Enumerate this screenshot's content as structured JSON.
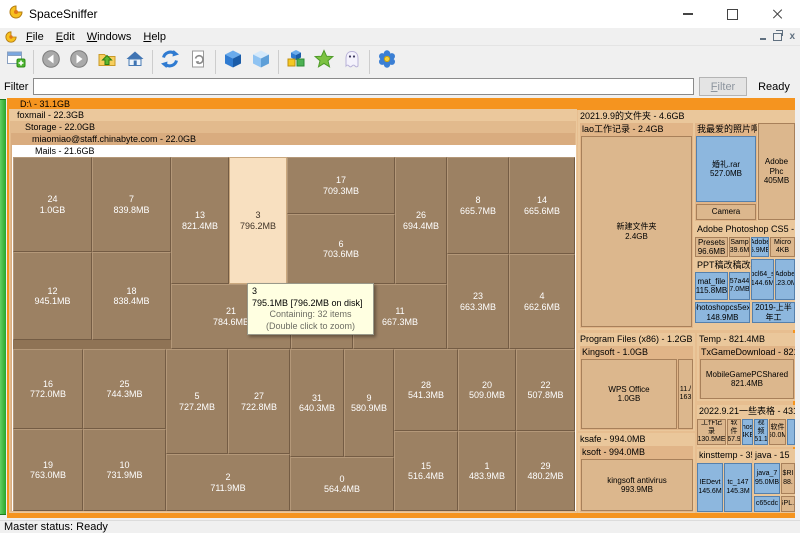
{
  "window": {
    "title": "SpaceSniffer"
  },
  "menu": {
    "items": [
      {
        "label": "File"
      },
      {
        "label": "Edit"
      },
      {
        "label": "Windows"
      },
      {
        "label": "Help"
      }
    ]
  },
  "toolbar": {
    "groups": [
      [
        "new-view"
      ],
      [
        "back",
        "forward",
        "parent-folder",
        "home"
      ],
      [
        "refresh",
        "refresh-selection"
      ],
      [
        "cube-solid",
        "cube-free-space"
      ],
      [
        "cubes-detail",
        "star-filter",
        "ghost-hidden"
      ],
      [
        "options-flower"
      ]
    ]
  },
  "filter": {
    "label": "Filter",
    "input_value": "",
    "button_label": "Filter",
    "status": "Ready"
  },
  "status_bar": {
    "text": "Master status: Ready"
  },
  "treemap": {
    "root_header": "D:\\ - 31.1GB",
    "nested_headers": [
      {
        "text": "foxmail - 22.3GB",
        "x": 9,
        "y": 12,
        "w": 568,
        "h": 404,
        "indent": 8
      },
      {
        "text": "Storage - 22.0GB",
        "x": 10,
        "y": 24,
        "w": 566,
        "h": 391,
        "indent": 15
      },
      {
        "text": "miaomiao@staff.chinabyte.com - 22.0GB",
        "x": 11,
        "y": 36,
        "w": 564,
        "h": 378,
        "indent": 21
      },
      {
        "text": "Mails - 21.6GB",
        "x": 12,
        "y": 48,
        "w": 564,
        "h": 366,
        "indent": 23
      }
    ],
    "mails_blocks": [
      {
        "n": "24",
        "s": "1.0GB",
        "x": 0,
        "y": 0,
        "w": 79,
        "h": 95
      },
      {
        "n": "7",
        "s": "839.8MB",
        "x": 79,
        "y": 0,
        "w": 79,
        "h": 95
      },
      {
        "n": "13",
        "s": "821.4MB",
        "x": 158,
        "y": 0,
        "w": 58,
        "h": 127
      },
      {
        "n": "3",
        "s": "796.2MB",
        "x": 216,
        "y": 0,
        "w": 58,
        "h": 127,
        "hl": true
      },
      {
        "n": "17",
        "s": "709.3MB",
        "x": 274,
        "y": 0,
        "w": 108,
        "h": 57
      },
      {
        "n": "26",
        "s": "694.4MB",
        "x": 382,
        "y": 0,
        "w": 52,
        "h": 127
      },
      {
        "n": "8",
        "s": "665.7MB",
        "x": 434,
        "y": 0,
        "w": 62,
        "h": 97
      },
      {
        "n": "14",
        "s": "665.6MB",
        "x": 496,
        "y": 0,
        "w": 66,
        "h": 97
      },
      {
        "n": "6",
        "s": "703.6MB",
        "x": 274,
        "y": 57,
        "w": 108,
        "h": 70
      },
      {
        "n": "12",
        "s": "945.1MB",
        "x": 0,
        "y": 95,
        "w": 79,
        "h": 88
      },
      {
        "n": "18",
        "s": "838.4MB",
        "x": 79,
        "y": 95,
        "w": 79,
        "h": 88
      },
      {
        "n": "23",
        "s": "663.3MB",
        "x": 434,
        "y": 97,
        "w": 62,
        "h": 95
      },
      {
        "n": "4",
        "s": "662.6MB",
        "x": 496,
        "y": 97,
        "w": 66,
        "h": 95
      },
      {
        "n": "21",
        "s": "784.6MB",
        "x": 158,
        "y": 127,
        "w": 120,
        "h": 65
      },
      {
        "n": "",
        "s": "",
        "x": 278,
        "y": 127,
        "w": 62,
        "h": 65
      },
      {
        "n": "11",
        "s": "667.3MB",
        "x": 340,
        "y": 127,
        "w": 94,
        "h": 65
      },
      {
        "n": "16",
        "s": "772.0MB",
        "x": 0,
        "y": 192,
        "w": 70,
        "h": 80
      },
      {
        "n": "25",
        "s": "744.3MB",
        "x": 70,
        "y": 192,
        "w": 83,
        "h": 80
      },
      {
        "n": "5",
        "s": "727.2MB",
        "x": 153,
        "y": 192,
        "w": 62,
        "h": 105
      },
      {
        "n": "27",
        "s": "722.8MB",
        "x": 215,
        "y": 192,
        "w": 62,
        "h": 105
      },
      {
        "n": "31",
        "s": "640.3MB",
        "x": 277,
        "y": 192,
        "w": 54,
        "h": 108
      },
      {
        "n": "9",
        "s": "580.9MB",
        "x": 331,
        "y": 192,
        "w": 50,
        "h": 108
      },
      {
        "n": "28",
        "s": "541.3MB",
        "x": 381,
        "y": 192,
        "w": 64,
        "h": 82
      },
      {
        "n": "20",
        "s": "509.0MB",
        "x": 445,
        "y": 192,
        "w": 58,
        "h": 82
      },
      {
        "n": "22",
        "s": "507.8MB",
        "x": 503,
        "y": 192,
        "w": 59,
        "h": 82
      },
      {
        "n": "19",
        "s": "763.0MB",
        "x": 0,
        "y": 272,
        "w": 70,
        "h": 82
      },
      {
        "n": "10",
        "s": "731.9MB",
        "x": 70,
        "y": 272,
        "w": 83,
        "h": 82
      },
      {
        "n": "2",
        "s": "711.9MB",
        "x": 153,
        "y": 297,
        "w": 124,
        "h": 57
      },
      {
        "n": "0",
        "s": "564.4MB",
        "x": 277,
        "y": 300,
        "w": 104,
        "h": 54
      },
      {
        "n": "15",
        "s": "516.4MB",
        "x": 381,
        "y": 274,
        "w": 64,
        "h": 80
      },
      {
        "n": "1",
        "s": "483.9MB",
        "x": 445,
        "y": 274,
        "w": 58,
        "h": 80
      },
      {
        "n": "29",
        "s": "480.2MB",
        "x": 503,
        "y": 274,
        "w": 59,
        "h": 80
      }
    ],
    "tooltip": {
      "title": "3",
      "size_line": "795.1MB [796.2MB on disk]",
      "containing": "Containing: 32 items",
      "hint": "(Double click to zoom)"
    },
    "right_panel": [
      {
        "k": "w",
        "x": 578,
        "y": 13,
        "w": 217,
        "h": 220,
        "c": "w1"
      },
      {
        "k": "h",
        "text": "2021.9.9的文件夹 - 4.6GB",
        "x": 578,
        "y": 13,
        "w": 217,
        "h": 12
      },
      {
        "k": "w",
        "x": 580,
        "y": 26,
        "w": 113,
        "h": 205,
        "c": "w2"
      },
      {
        "k": "h",
        "text": "lao工作记录 - 2.4GB",
        "x": 580,
        "y": 26,
        "w": 113,
        "h": 12
      },
      {
        "k": "b",
        "l1": "新建文件夹",
        "l2": "2.4GB",
        "x": 581,
        "y": 39,
        "w": 111,
        "h": 191,
        "c": "tan"
      },
      {
        "k": "w",
        "x": 695,
        "y": 26,
        "w": 62,
        "h": 98,
        "c": "w2"
      },
      {
        "k": "h",
        "text": "我最爱的照片啊 - 65",
        "x": 695,
        "y": 26,
        "w": 62,
        "h": 12
      },
      {
        "k": "b",
        "l1": "婚礼.rar",
        "l2": "527.0MB",
        "x": 696,
        "y": 39,
        "w": 60,
        "h": 66,
        "c": "blue"
      },
      {
        "k": "b",
        "l1": "Camera",
        "x": 696,
        "y": 107,
        "w": 60,
        "h": 16,
        "c": "tan"
      },
      {
        "k": "b",
        "l1": "Adobe Phc",
        "l2": "405MB",
        "x": 758,
        "y": 26,
        "w": 37,
        "h": 97,
        "c": "tan"
      },
      {
        "k": "h",
        "text": "Adobe Photoshop CS5 - 387.1M",
        "x": 695,
        "y": 126,
        "w": 100,
        "h": 12
      },
      {
        "k": "b",
        "l1": "Presets",
        "l2": "96.6MB",
        "x": 695,
        "y": 140,
        "w": 33,
        "h": 20,
        "c": "tan"
      },
      {
        "k": "b",
        "l1": "Samp",
        "l2": "39.6M",
        "x": 729,
        "y": 140,
        "w": 21,
        "h": 20,
        "c": "tan"
      },
      {
        "k": "b",
        "l1": "Adobe",
        "l2": "5.9ME",
        "x": 751,
        "y": 140,
        "w": 18,
        "h": 20,
        "c": "blue"
      },
      {
        "k": "b",
        "l1": "Micro",
        "l2": "4KB",
        "x": 770,
        "y": 140,
        "w": 25,
        "h": 20,
        "c": "tan"
      },
      {
        "k": "h",
        "text": "PPT稿改稿改稿改",
        "x": 695,
        "y": 162,
        "w": 56,
        "h": 12
      },
      {
        "k": "b",
        "l1": "pcl64_s",
        "l2": "144.6M",
        "x": 751,
        "y": 162,
        "w": 23,
        "h": 41,
        "c": "blue"
      },
      {
        "k": "b",
        "l1": "Adobe",
        "l2": "123.0M",
        "x": 775,
        "y": 162,
        "w": 20,
        "h": 41,
        "c": "blue"
      },
      {
        "k": "b",
        "l1": "mat_file",
        "l2": "115.8MB",
        "x": 695,
        "y": 175,
        "w": 33,
        "h": 28,
        "c": "blue"
      },
      {
        "k": "b",
        "l1": "57a44",
        "l2": "7.0MB",
        "x": 729,
        "y": 175,
        "w": 21,
        "h": 28,
        "c": "blue"
      },
      {
        "k": "b",
        "l1": "photoshopcs5ext",
        "l2": "148.9MB",
        "x": 695,
        "y": 205,
        "w": 55,
        "h": 21,
        "c": "blue"
      },
      {
        "k": "b",
        "l1": "2019-上半年工",
        "x": 752,
        "y": 205,
        "w": 43,
        "h": 21,
        "c": "blue"
      },
      {
        "k": "w",
        "x": 578,
        "y": 236,
        "w": 117,
        "h": 98,
        "c": "w1"
      },
      {
        "k": "h",
        "text": "Program Files (x86) - 1.2GB",
        "x": 578,
        "y": 236,
        "w": 117,
        "h": 12
      },
      {
        "k": "w",
        "x": 580,
        "y": 249,
        "w": 113,
        "h": 84,
        "c": "w2"
      },
      {
        "k": "h",
        "text": "Kingsoft - 1.0GB",
        "x": 580,
        "y": 249,
        "w": 113,
        "h": 12
      },
      {
        "k": "b",
        "l1": "WPS Office",
        "l2": "1.0GB",
        "x": 581,
        "y": 262,
        "w": 96,
        "h": 70,
        "c": "tan"
      },
      {
        "k": "b",
        "l1": "11./",
        "l2": "163",
        "x": 678,
        "y": 262,
        "w": 15,
        "h": 70,
        "c": "tan"
      },
      {
        "k": "w",
        "x": 697,
        "y": 236,
        "w": 98,
        "h": 68,
        "c": "w1"
      },
      {
        "k": "h",
        "text": "Temp - 821.4MB",
        "x": 697,
        "y": 236,
        "w": 98,
        "h": 12
      },
      {
        "k": "w",
        "x": 699,
        "y": 249,
        "w": 96,
        "h": 53,
        "c": "w2"
      },
      {
        "k": "h",
        "text": "TxGameDownload - 821.4MB",
        "x": 699,
        "y": 249,
        "w": 96,
        "h": 12
      },
      {
        "k": "b",
        "l1": "MobileGamePCShared",
        "l2": "821.4MB",
        "x": 700,
        "y": 262,
        "w": 94,
        "h": 40,
        "c": "tan"
      },
      {
        "k": "w",
        "x": 697,
        "y": 308,
        "w": 98,
        "h": 42,
        "c": "w1"
      },
      {
        "k": "h",
        "text": "2022.9.21一些表格 - 431.1MB",
        "x": 697,
        "y": 308,
        "w": 98,
        "h": 12
      },
      {
        "k": "b",
        "l1": "工作记录",
        "l2": "130.5ME",
        "x": 697,
        "y": 322,
        "w": 29,
        "h": 26,
        "c": "tan"
      },
      {
        "k": "b",
        "l1": "软件",
        "l2": "67.9",
        "x": 727,
        "y": 322,
        "w": 14,
        "h": 26,
        "c": "tan"
      },
      {
        "k": "b",
        "l1": "hos",
        "l2": "4KE",
        "x": 742,
        "y": 322,
        "w": 11,
        "h": 26,
        "c": "blue"
      },
      {
        "k": "b",
        "l1": "视频",
        "l2": "51.1",
        "x": 754,
        "y": 322,
        "w": 14,
        "h": 26,
        "c": "blue"
      },
      {
        "k": "b",
        "l1": "软件",
        "l2": "60.0M",
        "x": 769,
        "y": 322,
        "w": 17,
        "h": 26,
        "c": "tan"
      },
      {
        "k": "b",
        "l1": "",
        "x": 787,
        "y": 322,
        "w": 8,
        "h": 26,
        "c": "blue"
      },
      {
        "k": "w",
        "x": 578,
        "y": 336,
        "w": 117,
        "h": 80,
        "c": "w1"
      },
      {
        "k": "h",
        "text": "ksafe - 994.0MB",
        "x": 578,
        "y": 336,
        "w": 117,
        "h": 12
      },
      {
        "k": "w",
        "x": 580,
        "y": 349,
        "w": 113,
        "h": 66,
        "c": "w2"
      },
      {
        "k": "h",
        "text": "ksoft - 994.0MB",
        "x": 580,
        "y": 349,
        "w": 113,
        "h": 12
      },
      {
        "k": "b",
        "l1": "kingsoft antivirus",
        "l2": "993.9MB",
        "x": 581,
        "y": 362,
        "w": 112,
        "h": 52,
        "c": "tan"
      },
      {
        "k": "w",
        "x": 697,
        "y": 352,
        "w": 55,
        "h": 64,
        "c": "w1"
      },
      {
        "k": "h",
        "text": "kinsttemp - 358.",
        "x": 697,
        "y": 352,
        "w": 55,
        "h": 12
      },
      {
        "k": "b",
        "l1": "IEDevt",
        "l2": "145.6M",
        "x": 697,
        "y": 366,
        "w": 26,
        "h": 49,
        "c": "blue"
      },
      {
        "k": "b",
        "l1": "tc_147",
        "l2": "145.3M",
        "x": 724,
        "y": 366,
        "w": 28,
        "h": 49,
        "c": "blue"
      },
      {
        "k": "w",
        "x": 753,
        "y": 352,
        "w": 42,
        "h": 64,
        "c": "w1"
      },
      {
        "k": "h",
        "text": "java - 15",
        "x": 753,
        "y": 352,
        "w": 42,
        "h": 12
      },
      {
        "k": "b",
        "l1": "java_7",
        "l2": "95.0MB",
        "x": 754,
        "y": 366,
        "w": 26,
        "h": 31,
        "c": "blue"
      },
      {
        "k": "b",
        "l1": "$RI",
        "l2": "88.",
        "x": 781,
        "y": 366,
        "w": 14,
        "h": 31,
        "c": "tan"
      },
      {
        "k": "b",
        "l1": "c65cdc",
        "x": 754,
        "y": 399,
        "w": 26,
        "h": 16,
        "c": "blue"
      },
      {
        "k": "b",
        "l1": "GPL.h",
        "x": 781,
        "y": 399,
        "w": 14,
        "h": 16,
        "c": "tan"
      }
    ]
  },
  "colors": {
    "accent_orange": "#f5941f",
    "folder_tan": "#dcb78d",
    "file_blue": "#8db7de",
    "block_brown": "#9c8163",
    "highlight_cream": "#f8e0c0",
    "free_space_green": "#2aa42a"
  }
}
